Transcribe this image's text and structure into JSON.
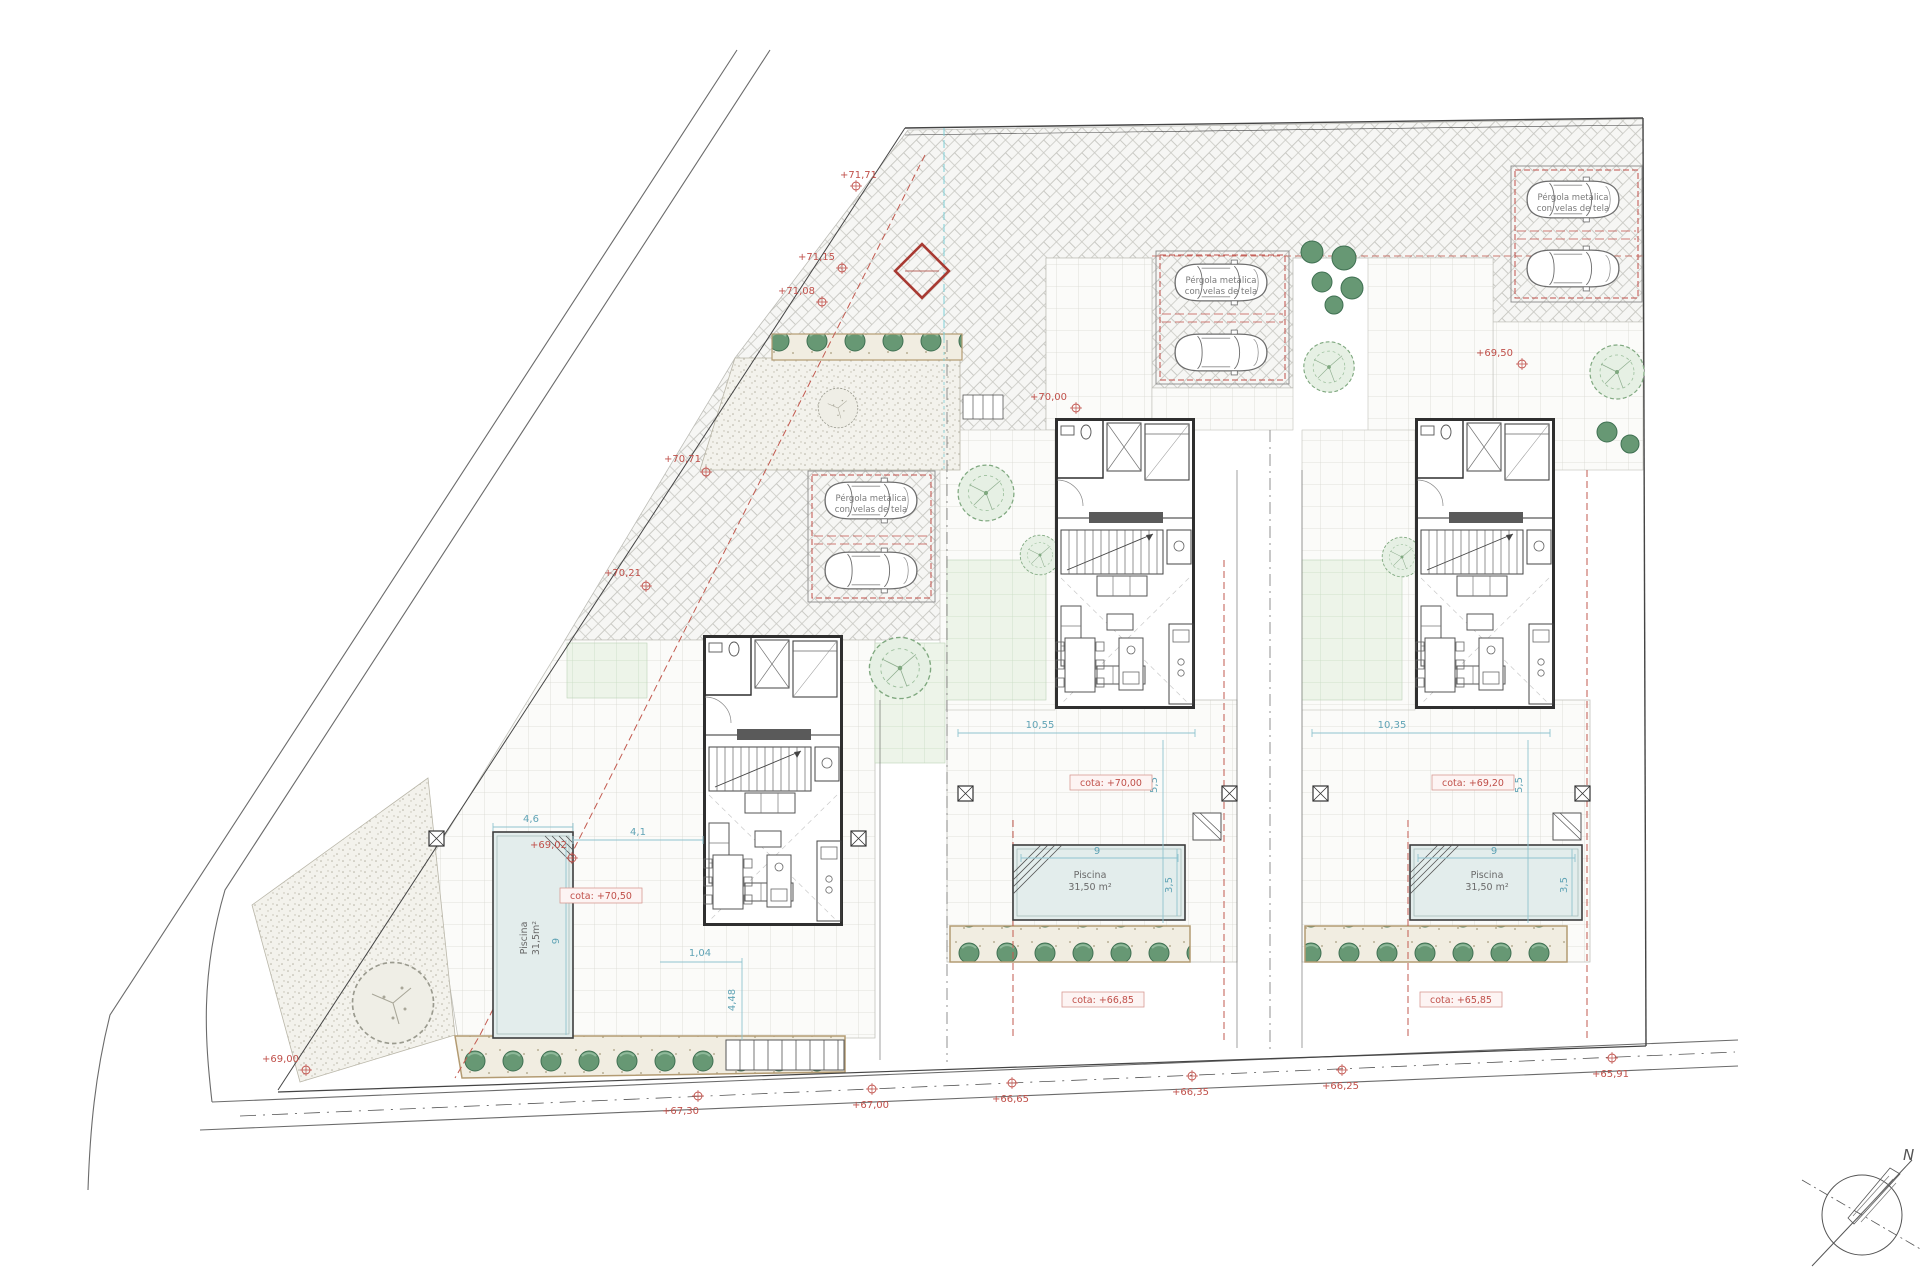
{
  "annotations": {
    "pergola_note_line1": "Pérgola metálica",
    "pergola_note_line2": "con velas de tela",
    "pool_left_line1": "Piscina",
    "pool_left_line2": "31,5m²",
    "pool_line1": "Piscina",
    "pool_line2": "31,50 m²",
    "cota_left": "cota: +70,50",
    "cota_mid": "cota: +70,00",
    "cota_right": "cota: +69,20",
    "cota_mid_low": "cota: +66,85",
    "cota_right_low": "cota: +65,85",
    "compass_north": "N"
  },
  "levels": {
    "t1": "+71,71",
    "t2": "+71,15",
    "t3": "+71,08",
    "t4": "+70,71",
    "t5": "+70,21",
    "t6": "+69,02",
    "t7": "+69,00",
    "t8": "+70,00",
    "t9": "+69,50",
    "b1": "+67,30",
    "b2": "+67,00",
    "b3": "+66,65",
    "b4": "+66,35",
    "b5": "+66,25",
    "b6": "+65,91"
  },
  "dims": {
    "d46": "4,6",
    "d41": "4,1",
    "d9": "9",
    "d104": "1,04",
    "d448": "4,48",
    "d35": "3,5",
    "d1055": "10,55",
    "d55": "5,5",
    "d1035": "10,35"
  },
  "colors": {
    "accent_red": "#c0504a",
    "dim_blue": "#5fa3b5",
    "pool_fill": "#e3edec",
    "hedge_green": "#5c8f6d"
  }
}
